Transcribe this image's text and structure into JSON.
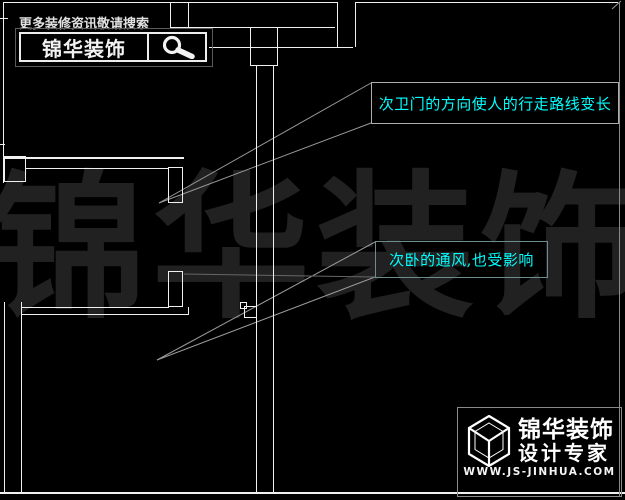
{
  "promo": {
    "search_hint": "更多装修资讯敬请搜索",
    "brand": "锦华装饰"
  },
  "annotations": {
    "bathroom_door": "次卫门的方向使人的行走路线变长",
    "bedroom_vent": "次卧的通风,也受影响"
  },
  "watermark": {
    "text": "锦华装饰"
  },
  "footer": {
    "brand": "锦华装饰",
    "tagline": "设计专家",
    "website": "WWW.JS-JINHUA.COM"
  },
  "colors": {
    "background": "#000000",
    "cad_line": "#f0f0f0",
    "leader_line": "#9a9a9a",
    "annotation_text": "#00ffff",
    "annotation1_border": "#adadad",
    "annotation2_border": "#6d8d8d",
    "watermark_text": "#212121"
  },
  "icons": {
    "search": "magnifier-icon",
    "logo": "cube-icon"
  }
}
